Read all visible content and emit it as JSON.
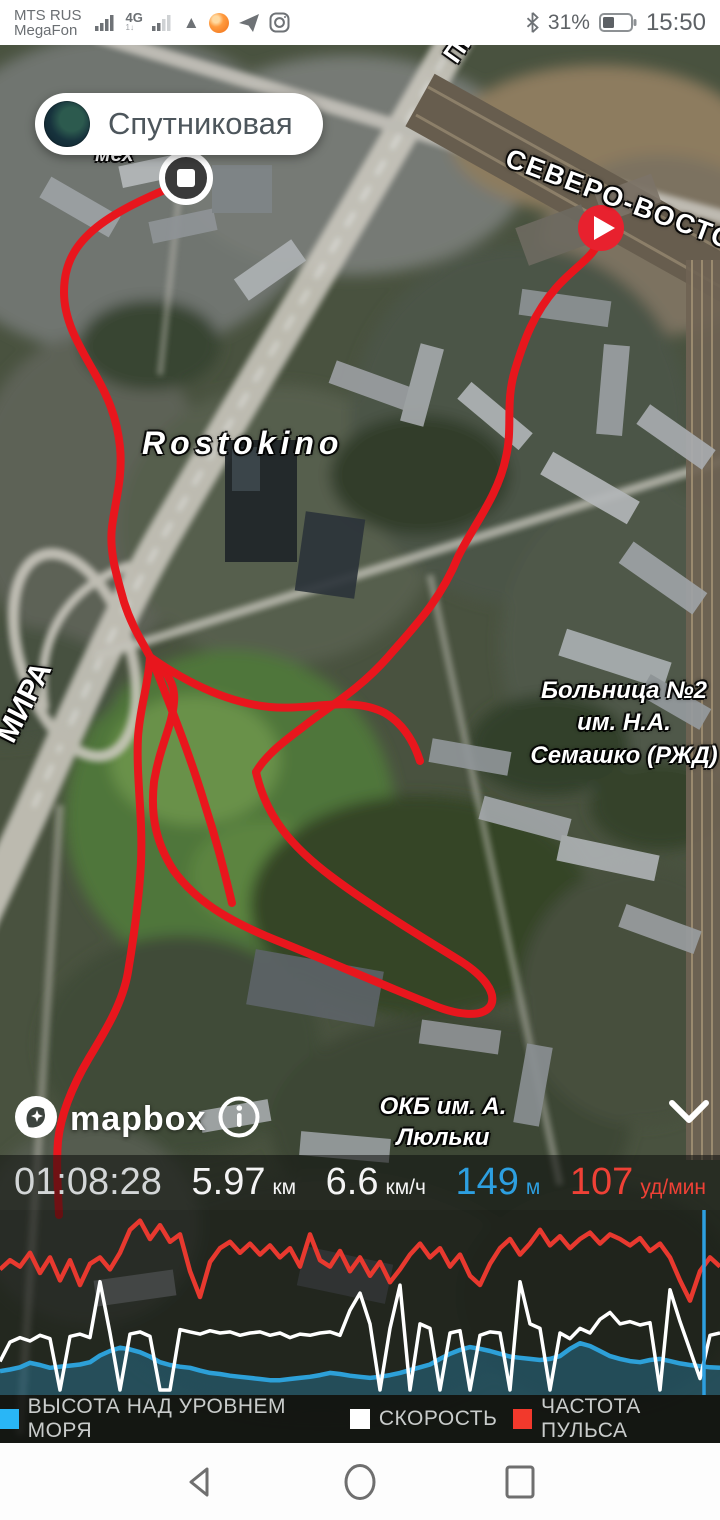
{
  "status_bar": {
    "carrier_line1": "MTS RUS",
    "carrier_line2": "MegaFon",
    "network_badge": "4G",
    "battery_percent": "31%",
    "time": "15:50",
    "icons": [
      "signal-bars-icon",
      "signal-bars-2-icon",
      "vpn-triangle-icon",
      "orange-app-icon",
      "telegram-icon",
      "instagram-icon",
      "bluetooth-icon",
      "battery-icon"
    ]
  },
  "map": {
    "layer_button_label": "Спутниковая",
    "labels": {
      "small_street": "мех",
      "rostokino": "Rostokino",
      "road_ne": "СЕВЕРО-ВОСТОЧ",
      "road_pro": "ПРО",
      "road_mira": "МИРА",
      "hospital": "Больница №2 им. Н.А. Семашко (РЖД)",
      "okb": "ОКБ им. А. Люльки"
    },
    "attribution": "mapbox",
    "markers": {
      "start": "play-marker",
      "finish": "stop-marker"
    },
    "route_color": "#e8161d"
  },
  "stats": {
    "duration": "01:08:28",
    "distance_value": "5.97",
    "distance_unit": "км",
    "speed_value": "6.6",
    "speed_unit": "км/ч",
    "elevation_value": "149",
    "elevation_unit": "м",
    "elevation_color": "#2d9fe0",
    "heart_rate_value": "107",
    "heart_rate_unit": "уд/мин",
    "heart_rate_color": "#ef4136"
  },
  "legend": {
    "0": {
      "label": "ВЫСОТА НАД УРОВНЕМ МОРЯ",
      "color": "#29b6f6"
    },
    "1": {
      "label": "СКОРОСТЬ",
      "color": "#ffffff"
    },
    "2": {
      "label": "ЧАСТОТА ПУЛЬСА",
      "color": "#f2392c"
    }
  },
  "chart_data": {
    "type": "line",
    "title": "",
    "xlabel": "",
    "ylabel": "",
    "grid": false,
    "axes_visible": false,
    "legend_position": "bottom",
    "cursor_x_fraction": 0.978,
    "cursor_color": "#2d9fe0",
    "series": [
      {
        "name": "ВЫСОТА НАД УРОВНЕМ МОРЯ",
        "color": "#2da0d8",
        "style": "area",
        "current": "149 м",
        "values": [
          0.3,
          0.33,
          0.37,
          0.45,
          0.41,
          0.36,
          0.38,
          0.4,
          0.42,
          0.46,
          0.58,
          0.66,
          0.72,
          0.69,
          0.64,
          0.56,
          0.46,
          0.41,
          0.38,
          0.36,
          0.31,
          0.27,
          0.25,
          0.22,
          0.2,
          0.18,
          0.16,
          0.14,
          0.14,
          0.16,
          0.18,
          0.2,
          0.23,
          0.27,
          0.25,
          0.22,
          0.2,
          0.18,
          0.2,
          0.23,
          0.27,
          0.32,
          0.37,
          0.42,
          0.52,
          0.61,
          0.68,
          0.73,
          0.7,
          0.66,
          0.61,
          0.56,
          0.54,
          0.52,
          0.5,
          0.52,
          0.57,
          0.7,
          0.8,
          0.75,
          0.66,
          0.57,
          0.52,
          0.48,
          0.46,
          0.5,
          0.52,
          0.48,
          0.44,
          0.41,
          0.39,
          0.37,
          0.36
        ]
      },
      {
        "name": "СКОРОСТЬ",
        "color": "#ffffff",
        "style": "line",
        "current": "6.6 км/ч",
        "values": [
          0.25,
          0.42,
          0.46,
          0.43,
          0.48,
          0.45,
          0.0,
          0.47,
          0.49,
          0.46,
          0.95,
          0.5,
          0.0,
          0.49,
          0.51,
          0.47,
          0.0,
          0.0,
          0.53,
          0.51,
          0.49,
          0.52,
          0.5,
          0.51,
          0.48,
          0.5,
          0.51,
          0.48,
          0.5,
          0.46,
          0.49,
          0.48,
          0.5,
          0.51,
          0.48,
          0.7,
          0.85,
          0.58,
          0.0,
          0.54,
          0.92,
          0.0,
          0.58,
          0.54,
          0.0,
          0.5,
          0.52,
          0.0,
          0.48,
          0.51,
          0.5,
          0.0,
          0.95,
          0.58,
          0.54,
          0.0,
          0.5,
          0.45,
          0.54,
          0.5,
          0.62,
          0.68,
          0.58,
          0.6,
          0.57,
          0.59,
          0.0,
          0.88,
          0.6,
          0.35,
          0.1,
          0.48,
          0.5
        ]
      },
      {
        "name": "ЧАСТОТА ПУЛЬСА",
        "color": "#e8392f",
        "style": "line",
        "current": "107 уд/мин",
        "values": [
          0.42,
          0.52,
          0.45,
          0.6,
          0.38,
          0.55,
          0.3,
          0.52,
          0.25,
          0.48,
          0.55,
          0.42,
          0.6,
          0.85,
          0.95,
          0.75,
          0.9,
          0.72,
          0.8,
          0.4,
          0.12,
          0.5,
          0.65,
          0.72,
          0.6,
          0.7,
          0.58,
          0.68,
          0.55,
          0.65,
          0.45,
          0.8,
          0.52,
          0.45,
          0.62,
          0.4,
          0.55,
          0.35,
          0.5,
          0.28,
          0.42,
          0.58,
          0.7,
          0.55,
          0.65,
          0.45,
          0.58,
          0.35,
          0.25,
          0.48,
          0.65,
          0.75,
          0.58,
          0.7,
          0.85,
          0.68,
          0.78,
          0.65,
          0.75,
          0.82,
          0.7,
          0.8,
          0.75,
          0.68,
          0.76,
          0.62,
          0.7,
          0.55,
          0.3,
          0.08,
          0.4,
          0.55,
          0.45
        ]
      }
    ],
    "note": "No axes or tick labels are shown on screen; values are normalized 0-1 within each series' drawn band. Current readouts: elevation 149 м, speed 6.6 км/ч, heart rate 107 уд/мин, distance 5.97 км, time 01:08:28."
  },
  "nav_bar": {
    "icons": [
      "back-triangle-icon",
      "home-circle-icon",
      "recents-square-icon"
    ]
  }
}
